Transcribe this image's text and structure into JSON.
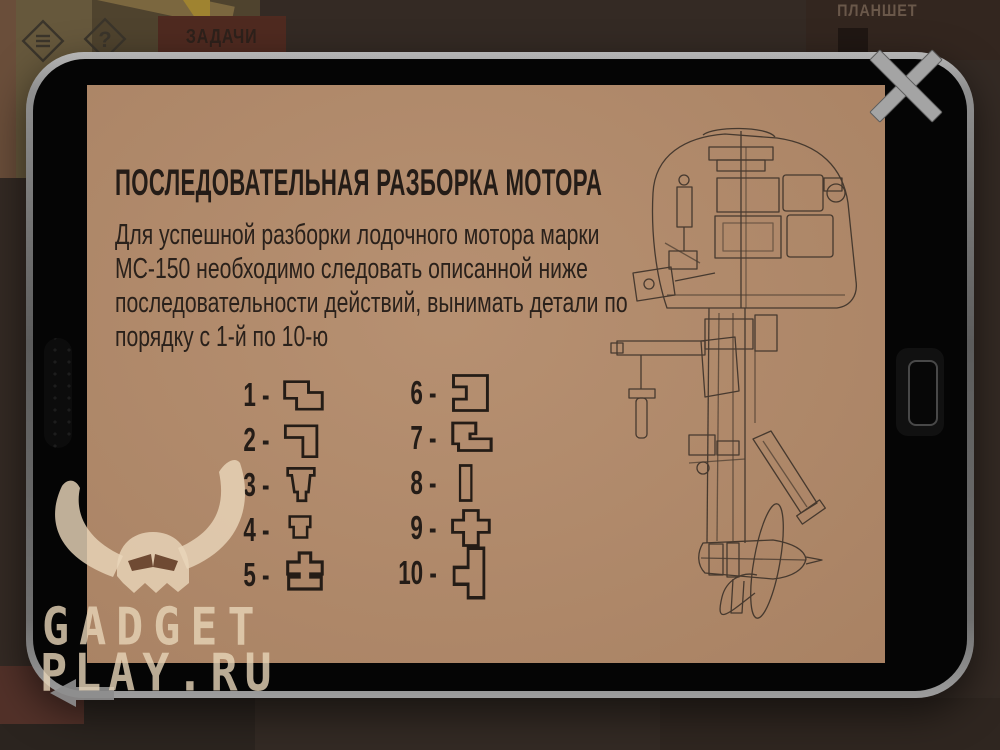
{
  "scene": {
    "tasks_button_label": "ЗАДАЧИ",
    "tablet_caption": "ПЛАНШЕТ",
    "help_glyph": "?"
  },
  "tablet": {
    "title": "ПОСЛЕДОВАТЕЛЬНАЯ РАЗБОРКА МОТОРА",
    "paragraph_lines": [
      "Для успешной разборки лодочного мотора марки",
      "МС-150 необходимо следовать описанной ниже",
      "последовательности действий, вынимать детали по",
      "порядку с 1-й по 10-ю"
    ],
    "sequence": [
      {
        "label": "1 -",
        "shape": "step-block"
      },
      {
        "label": "2 -",
        "shape": "corner-block"
      },
      {
        "label": "3 -",
        "shape": "tapered-pin"
      },
      {
        "label": "4 -",
        "shape": "cup-block"
      },
      {
        "label": "5 -",
        "shape": "cross-base"
      },
      {
        "label": "6 -",
        "shape": "notched-block"
      },
      {
        "label": "7 -",
        "shape": "step-foot-block"
      },
      {
        "label": "8 -",
        "shape": "bar-block"
      },
      {
        "label": "9 -",
        "shape": "cross-block"
      },
      {
        "label": "10 -",
        "shape": "tabbed-bar"
      }
    ],
    "illustration": "outboard-motor-cutaway-drawing"
  },
  "watermark": {
    "line1": "GADGET",
    "line2": "PLAY.RU"
  },
  "colors": {
    "screen": "#b28a6a",
    "ink": "#241c16",
    "frame": "#8f8f8f",
    "bezel": "#050505",
    "background": "#342a24",
    "tasks_banner": "#4f2a20",
    "watermark": "#e8d5ba"
  }
}
